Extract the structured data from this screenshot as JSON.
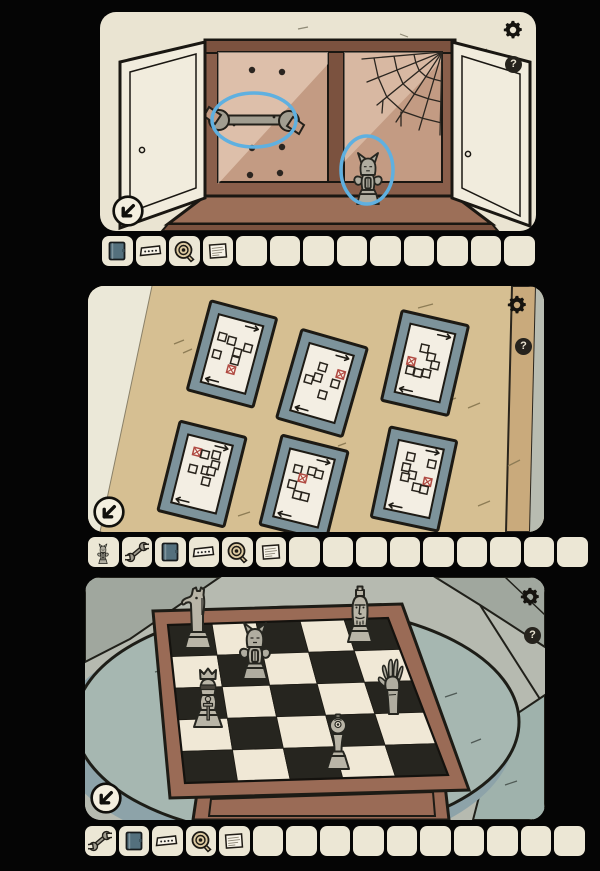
{
  "ui": {
    "help_glyph": "?",
    "settings_icon": "gear-icon",
    "help_icon": "question-icon",
    "nav_icon": "arrow-down-left-icon"
  },
  "colors": {
    "panel_bg": "#eae4d2",
    "slot_bg": "#ece7d5",
    "highlight_blue": "#5fb0e0",
    "red_mark": "#b04a42",
    "frame_mat": "#7d939b",
    "paper": "#f3eee3",
    "wall_tan": "#d6bf92",
    "wood": "#9a6b56",
    "board_dark": "#26251f",
    "board_light": "#f0e8d6",
    "piece_gray": "#b9b5a7",
    "table_teal": "#a6b7b1",
    "floor_gray": "#b6bab0"
  },
  "panels": [
    {
      "id": "cabinet",
      "hints": [
        "wrench",
        "gargoyle"
      ],
      "inventory": {
        "items": [
          "book",
          "strip",
          "tape",
          "note"
        ],
        "slots": 13
      }
    },
    {
      "id": "pattern-frames",
      "cards": [
        {
          "cx": 144,
          "cy": 68,
          "rot": 15,
          "squares": [
            {
              "x": 0.2,
              "y": 0.3
            },
            {
              "x": 0.42,
              "y": 0.32
            },
            {
              "x": 0.8,
              "y": 0.36
            },
            {
              "x": 0.6,
              "y": 0.46
            },
            {
              "x": 0.18,
              "y": 0.56
            },
            {
              "x": 0.6,
              "y": 0.58
            },
            {
              "x": 0.57,
              "y": 0.72,
              "red": true
            }
          ]
        },
        {
          "cx": 234,
          "cy": 97,
          "rot": 16,
          "squares": [
            {
              "x": 0.42,
              "y": 0.28
            },
            {
              "x": 0.84,
              "y": 0.31,
              "red": true
            },
            {
              "x": 0.38,
              "y": 0.44
            },
            {
              "x": 0.78,
              "y": 0.46
            },
            {
              "x": 0.2,
              "y": 0.5
            },
            {
              "x": 0.58,
              "y": 0.66
            }
          ]
        },
        {
          "cx": 337,
          "cy": 77,
          "rot": 13,
          "squares": [
            {
              "x": 0.42,
              "y": 0.3
            },
            {
              "x": 0.6,
              "y": 0.4
            },
            {
              "x": 0.2,
              "y": 0.52,
              "red": true
            },
            {
              "x": 0.72,
              "y": 0.5
            },
            {
              "x": 0.22,
              "y": 0.65
            },
            {
              "x": 0.4,
              "y": 0.66
            },
            {
              "x": 0.58,
              "y": 0.64
            }
          ]
        },
        {
          "cx": 114,
          "cy": 188,
          "rot": 14,
          "squares": [
            {
              "x": 0.28,
              "y": 0.21,
              "red": true
            },
            {
              "x": 0.46,
              "y": 0.22
            },
            {
              "x": 0.7,
              "y": 0.19
            },
            {
              "x": 0.73,
              "y": 0.33
            },
            {
              "x": 0.28,
              "y": 0.46
            },
            {
              "x": 0.56,
              "y": 0.44
            },
            {
              "x": 0.68,
              "y": 0.43
            },
            {
              "x": 0.62,
              "y": 0.59
            }
          ]
        },
        {
          "cx": 216,
          "cy": 202,
          "rot": 14,
          "squares": [
            {
              "x": 0.27,
              "y": 0.26
            },
            {
              "x": 0.58,
              "y": 0.24
            },
            {
              "x": 0.74,
              "y": 0.26
            },
            {
              "x": 0.42,
              "y": 0.37,
              "red": true
            },
            {
              "x": 0.23,
              "y": 0.49
            },
            {
              "x": 0.39,
              "y": 0.62
            },
            {
              "x": 0.56,
              "y": 0.62
            }
          ]
        },
        {
          "cx": 326,
          "cy": 193,
          "rot": 12,
          "squares": [
            {
              "x": 0.33,
              "y": 0.2
            },
            {
              "x": 0.81,
              "y": 0.24
            },
            {
              "x": 0.28,
              "y": 0.36
            },
            {
              "x": 0.44,
              "y": 0.45
            },
            {
              "x": 0.3,
              "y": 0.5
            },
            {
              "x": 0.8,
              "y": 0.5,
              "red": true
            },
            {
              "x": 0.59,
              "y": 0.61
            },
            {
              "x": 0.76,
              "y": 0.62
            }
          ]
        }
      ],
      "inventory": {
        "items": [
          "gargoyle",
          "wrench",
          "book",
          "strip",
          "tape",
          "note"
        ],
        "slots": 15
      }
    },
    {
      "id": "chessboard",
      "board": {
        "cols": 5,
        "rows": 5,
        "quad": {
          "bl": [
            83,
            48
          ],
          "br": [
            303,
            41
          ],
          "fl": [
            100,
            206
          ],
          "fr": [
            363,
            198
          ]
        },
        "pieces": [
          {
            "type": "knight",
            "row": 0,
            "col": 0,
            "px": [
              113,
              72
            ],
            "size": [
              42,
              64
            ]
          },
          {
            "type": "king",
            "row": 0,
            "col": 3,
            "px": [
              275,
              66
            ],
            "size": [
              40,
              64
            ]
          },
          {
            "type": "gargoyle",
            "row": 1,
            "col": 1,
            "px": [
              170,
              103
            ],
            "size": [
              46,
              68
            ]
          },
          {
            "type": "hand",
            "row": 1,
            "col": 4,
            "px": [
              308,
              138
            ],
            "size": [
              44,
              63
            ]
          },
          {
            "type": "queen",
            "row": 2,
            "col": 0,
            "px": [
              123,
              151
            ],
            "size": [
              46,
              70
            ]
          },
          {
            "type": "pawn",
            "row": 3,
            "col": 2,
            "px": [
              253,
              193
            ],
            "size": [
              38,
              62
            ]
          }
        ]
      },
      "inventory": {
        "items": [
          "wrench",
          "book",
          "strip",
          "tape",
          "note"
        ],
        "slots": 15
      }
    }
  ]
}
